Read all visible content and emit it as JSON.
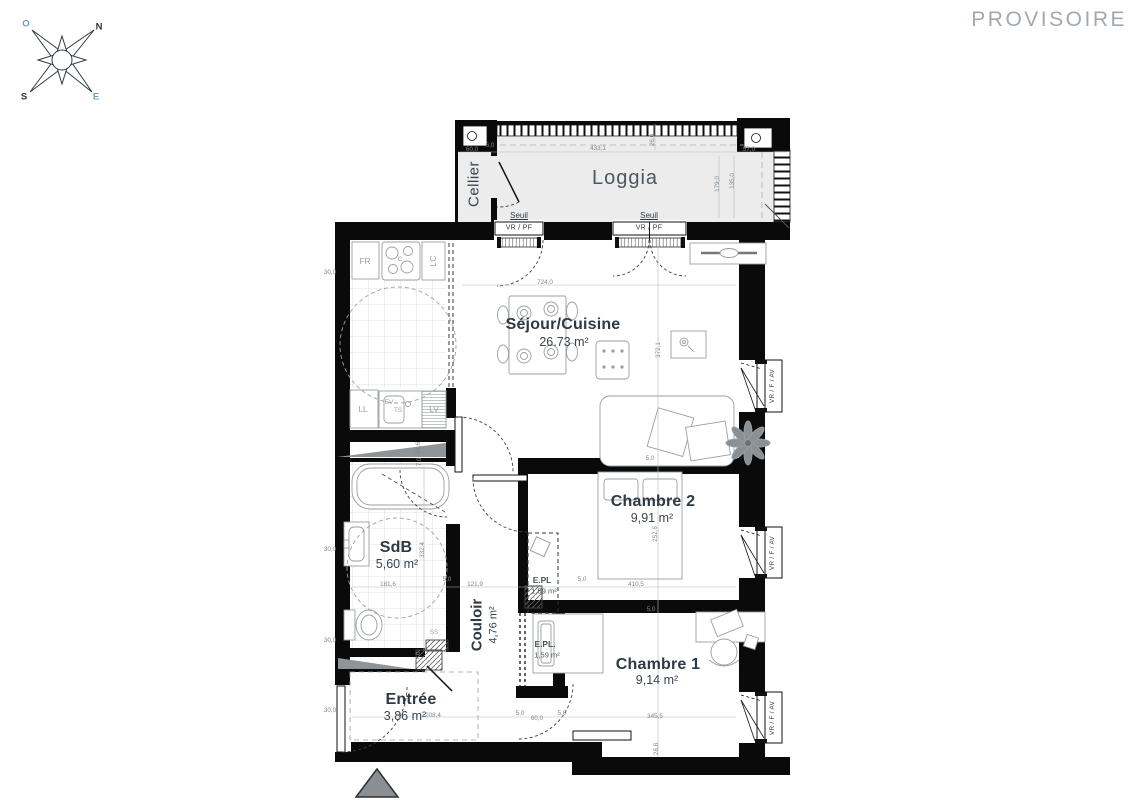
{
  "watermark": "PROVISOIRE",
  "compass": {
    "o": "O",
    "n": "N",
    "s": "S",
    "e": "E"
  },
  "rooms": {
    "loggia": {
      "name": "Loggia"
    },
    "cellier": {
      "name": "Cellier"
    },
    "sejour": {
      "name": "Séjour/Cuisine",
      "area": "26.73 m²"
    },
    "chambre2": {
      "name": "Chambre 2",
      "area": "9,91 m²"
    },
    "chambre1": {
      "name": "Chambre 1",
      "area": "9,14 m²"
    },
    "sdb": {
      "name": "SdB",
      "area": "5,60 m²"
    },
    "couloir": {
      "name": "Couloir",
      "area": "4,76 m²"
    },
    "entree": {
      "name": "Entrée",
      "area": "3,86 m²"
    },
    "epl_upper": {
      "name": "E.PL",
      "area": "1,59 m²"
    },
    "epl_lower": {
      "name": "E.PL.",
      "area": "1,59 m²"
    }
  },
  "openings": {
    "seuil": "Seuil",
    "threshold_type": "VR / PF",
    "window_type": "VR / F / AV"
  },
  "appliances": {
    "fr": "FR",
    "cooktop": "C",
    "lc": "LC",
    "ll": "LL",
    "ev": "EV",
    "ts": "TS",
    "lv": "LV",
    "ss": "SS"
  },
  "dims": [
    "60,0",
    "433,1",
    "57,0",
    "26,0",
    "179,0",
    "135,0",
    "724,0",
    "372,1",
    "5,0",
    "252,6",
    "410,5",
    "5,0",
    "121,9",
    "5,0",
    "181,6",
    "5,0",
    "332,4",
    "345,5",
    "28,8",
    "60,0",
    "5,0",
    "5,0",
    "208,4",
    "30,0",
    "30,0",
    "30,0",
    "30,0",
    "34,6",
    "7,0",
    "7,0",
    "6,0"
  ],
  "colors": {
    "wall": "#0a0a0a",
    "loggia_fill": "#ececec",
    "label": "#313d47",
    "dim_text": "#7e868d",
    "watermark": "#9fa9b2",
    "accent_blue": "#6f9cb8"
  }
}
